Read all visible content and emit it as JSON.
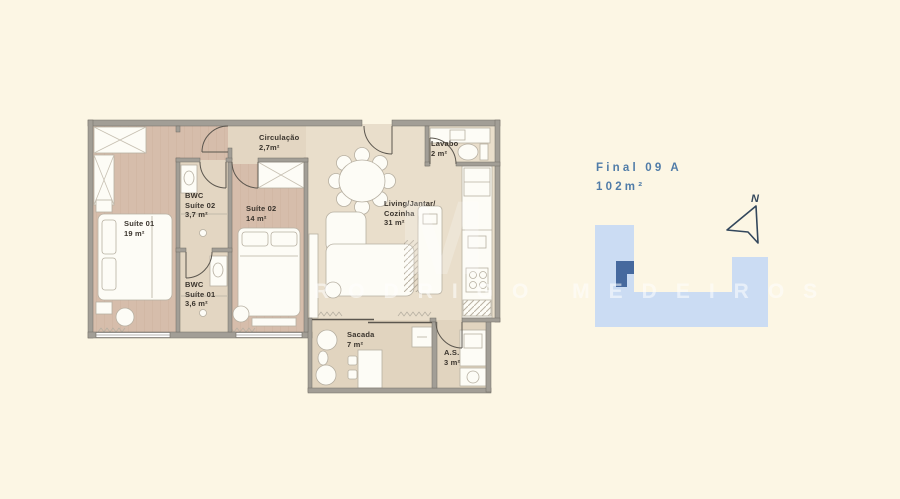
{
  "page": {
    "background": "#fcf6e4"
  },
  "watermark": {
    "text": "RODRIGO MEDEIROS",
    "monogram": "M"
  },
  "plan": {
    "rooms": {
      "suite01": {
        "name": "Suíte 01",
        "area": "19 m²"
      },
      "bwc_suite02": {
        "name_line1": "BWC",
        "name_line2": "Suíte 02",
        "area": "3,7 m²"
      },
      "suite02": {
        "name": "Suíte 02",
        "area": "14 m²"
      },
      "bwc_suite01": {
        "name_line1": "BWC",
        "name_line2": "Suíte 01",
        "area": "3,6 m²"
      },
      "circulacao": {
        "name": "Circulação",
        "area": "2,7m²"
      },
      "living": {
        "name_line1": "Living/Jantar/",
        "name_line2": "Cozinha",
        "area": "31 m²"
      },
      "lavabo": {
        "name": "Lavabo",
        "area": "2 m²"
      },
      "sacada": {
        "name": "Sacada",
        "area": "7 m²"
      },
      "as": {
        "name": "A.S.",
        "area": "3 m²"
      }
    }
  },
  "key_plan": {
    "unit_title": "Final 09 A",
    "unit_area": "102m²",
    "north_label": "N",
    "colors": {
      "building": "#cbdcf3",
      "unit_highlight": "#46699e",
      "title_text": "#507ca8"
    }
  }
}
